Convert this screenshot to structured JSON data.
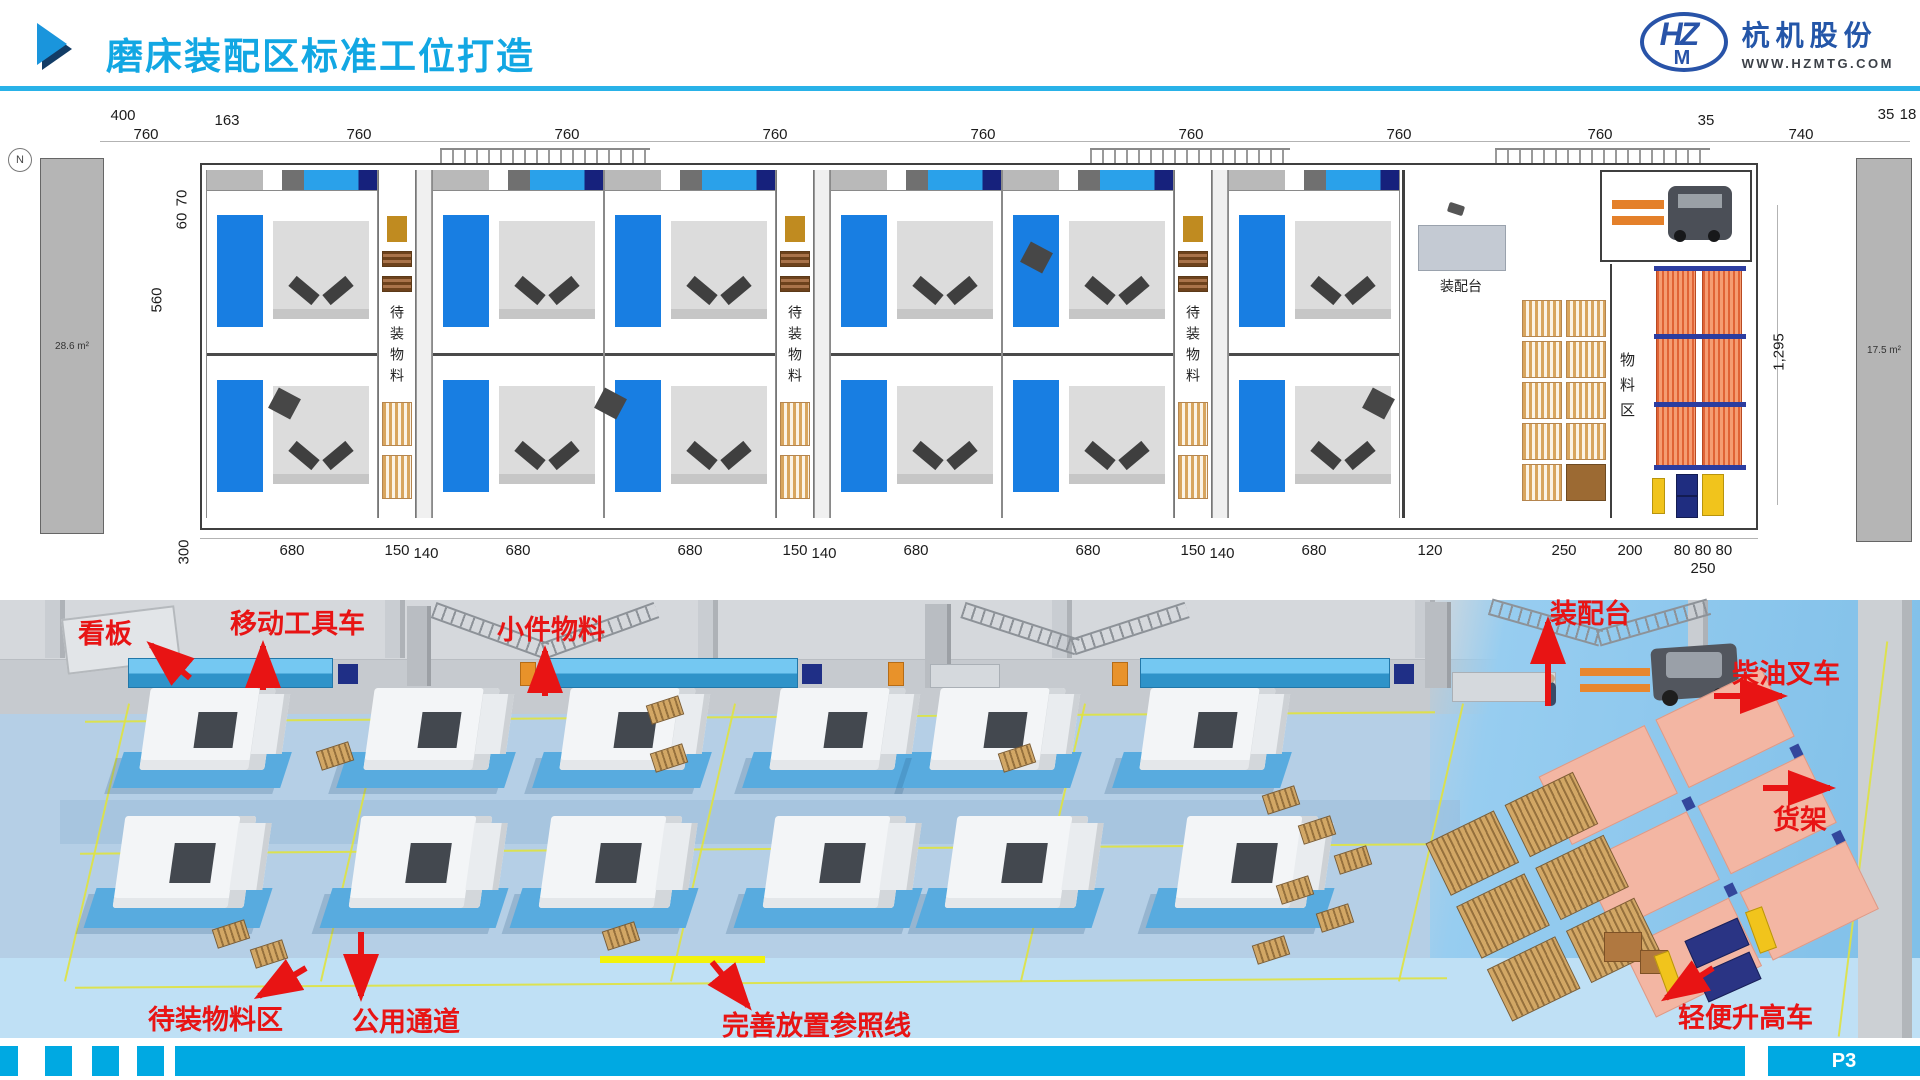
{
  "header": {
    "title": "磨床装配区标准工位打造",
    "logo": {
      "emblem_main": "HZ",
      "emblem_sub": "M",
      "company": "杭机股份",
      "website": "WWW.HZMTG.COM"
    }
  },
  "cad": {
    "compass": "N",
    "room_left_area": "28.6 m²",
    "room_right_area": "17.5 m²",
    "dims_top": [
      "400",
      "760",
      "163",
      "760",
      "760",
      "760",
      "760",
      "760",
      "760",
      "760",
      "35",
      "740",
      "35",
      "18"
    ],
    "dim_inner_width": "400",
    "dim_dock_depth": "200",
    "dim_total_height": "1,295",
    "dims_left": [
      "70",
      "60",
      "560",
      "300"
    ],
    "dims_bottom": [
      "680",
      "150",
      "140",
      "680",
      "680",
      "150",
      "140",
      "680",
      "680",
      "150",
      "140",
      "680",
      "120",
      "250",
      "200",
      "80 80 80",
      "250"
    ],
    "staging_strip_label": "待装物料",
    "assembly_station_label": "装配台",
    "material_area_label": "物料区"
  },
  "annotations": {
    "kanban": "看板",
    "mobile_tool_cart": "移动工具车",
    "small_parts": "小件物料",
    "assembly_station": "装配台",
    "diesel_forklift": "柴油叉车",
    "shelving": "货架",
    "staging_area": "待装物料区",
    "public_aisle": "公用通道",
    "placement_reference_line": "完善放置参照线",
    "light_lift_cart": "轻便升高车"
  },
  "footer": {
    "page": "P3"
  },
  "colors": {
    "accent": "#12a7e3",
    "annotation": "#e81414",
    "footer_bar": "#00a9e2",
    "machine_bed": "#187ee2"
  }
}
